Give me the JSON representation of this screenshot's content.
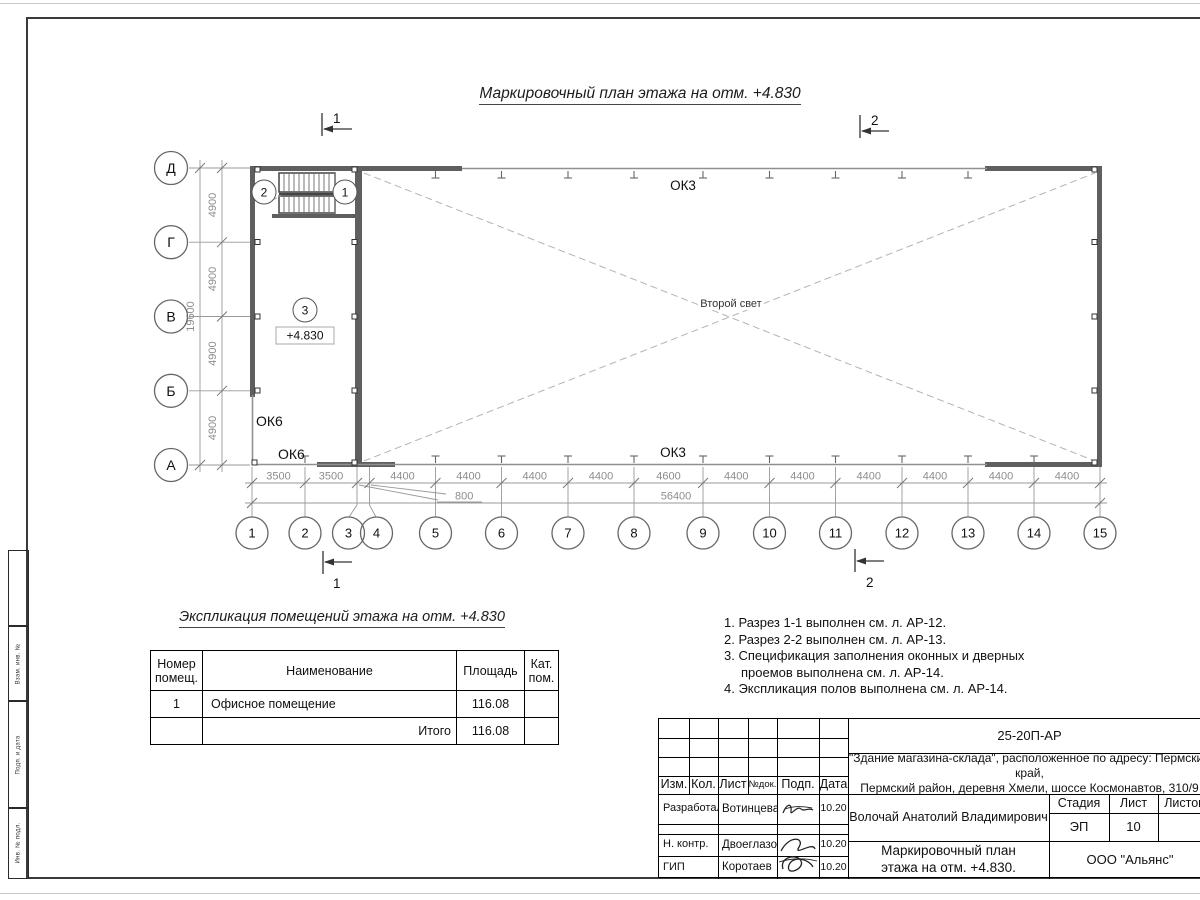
{
  "page": {
    "main_title": "Маркировочный план этажа на отм. +4.830"
  },
  "plan": {
    "row_axes": [
      "Д",
      "Г",
      "В",
      "Б",
      "А"
    ],
    "col_axes": [
      "1",
      "2",
      "3",
      "4",
      "5",
      "6",
      "7",
      "8",
      "9",
      "10",
      "11",
      "12",
      "13",
      "14",
      "15"
    ],
    "v_dim": "4900",
    "v_total": "19600",
    "h_dims": [
      "3500",
      "3500",
      "4400",
      "4400",
      "4400",
      "4400",
      "4600",
      "4400",
      "4400",
      "4400",
      "4400",
      "4400",
      "4400"
    ],
    "h_dim_small": "800",
    "h_total": "56400",
    "window_ok3": "ОК3",
    "window_ok6": "ОК6",
    "second_light": "Второй свет",
    "elevation": "+4.830",
    "room_mark": "3",
    "opening_marks": [
      "2",
      "1"
    ],
    "section_marks": [
      "1",
      "2"
    ]
  },
  "explication": {
    "title": "Экспликация помещений этажа на отм. +4.830",
    "headers": [
      "Номер помещ.",
      "Наименование",
      "Площадь",
      "Кат. пом."
    ],
    "rows": [
      [
        "1",
        "Офисное помещение",
        "116.08",
        ""
      ]
    ],
    "total_label": "Итого",
    "total_value": "116.08"
  },
  "notes": {
    "n1": "1. Разрез 1-1 выполнен см. л. АР-12.",
    "n2": "2. Разрез 2-2 выполнен см. л. АР-13.",
    "n3": "3. Спецификация заполнения оконных и дверных\nпроемов выполнена см. л. АР-14.",
    "n4": "4. Экспликация полов выполнена см. л. АР-14."
  },
  "titleblock": {
    "doc_number": "25-20П-АР",
    "object_line1": "\"Здание магазина-склада\", расположенное по адресу: Пермский край,",
    "object_line2": "Пермский район, деревня Хмели, шоссе Космонавтов, 310/9",
    "rev_headers": [
      "Изм.",
      "Кол.",
      "Лист",
      "№док.",
      "Подп.",
      "Дата"
    ],
    "signers": [
      {
        "role": "Разработал",
        "name": "Вотинцева",
        "date": "10.20"
      },
      {
        "role": "Н. контр.",
        "name": "Двоеглазов",
        "date": "10.20"
      },
      {
        "role": "ГИП",
        "name": "Коротаев",
        "date": "10.20"
      }
    ],
    "person": "Волочай Анатолий Владимирович",
    "stage_label": "Стадия",
    "sheet_label": "Лист",
    "sheets_label": "Листов",
    "stage": "ЭП",
    "sheet_no": "10",
    "drawing_title_line1": "Маркировочный план",
    "drawing_title_line2": "этажа на отм. +4.830.",
    "company": "ООО \"Альянс\""
  },
  "side_stamp": {
    "labels": [
      "Взам. инв. №",
      "Подп. и дата",
      "Инв. № подл."
    ]
  }
}
